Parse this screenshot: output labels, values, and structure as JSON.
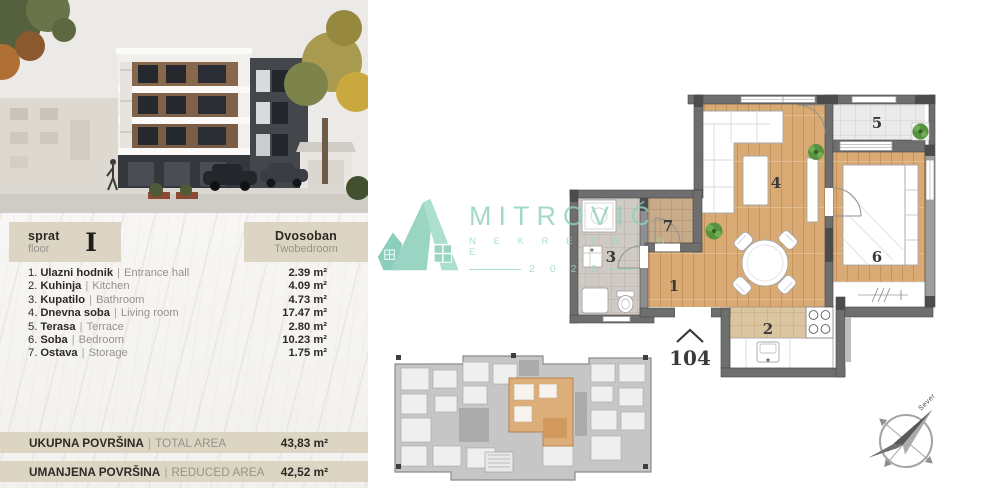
{
  "left_panel": {
    "sep": "|",
    "header": {
      "floor_label_sr": "sprat",
      "floor_label_en": "floor",
      "floor_value": "I",
      "unit_type_sr": "Dvosoban",
      "unit_type_en": "Twobedroom"
    },
    "rooms": [
      {
        "num": "1.",
        "sr": "Ulazni hodnik",
        "en": "Entrance hall",
        "area": "2.39 m²"
      },
      {
        "num": "2.",
        "sr": "Kuhinja",
        "en": "Kitchen",
        "area": "4.09 m²"
      },
      {
        "num": "3.",
        "sr": "Kupatilo",
        "en": "Bathroom",
        "area": "4.73 m²"
      },
      {
        "num": "4.",
        "sr": "Dnevna soba",
        "en": "Living room",
        "area": "17.47 m²"
      },
      {
        "num": "5.",
        "sr": "Terasa",
        "en": "Terrace",
        "area": "2.80 m²"
      },
      {
        "num": "6.",
        "sr": "Soba",
        "en": "Bedroom",
        "area": "10.23 m²"
      },
      {
        "num": "7.",
        "sr": "Ostava",
        "en": "Storage",
        "area": "1.75 m²"
      }
    ],
    "totals": [
      {
        "sr": "UKUPNA POVRŠINA",
        "en": "TOTAL AREA",
        "value": "43,83 m²"
      },
      {
        "sr": "UMANJENA POVRŠINA",
        "en": "REDUCED AREA",
        "value": "42,52 m²"
      }
    ]
  },
  "watermark": {
    "brand": "MITROVIĆ",
    "brand_sub": "N E K R E T N I N E",
    "year": "2 0 2 2",
    "color": "#8ed2bf"
  },
  "floorplan": {
    "unit_number": "104",
    "compass_label": "Sever",
    "labels": {
      "hall": "1",
      "kitchen": "2",
      "bathroom": "3",
      "living": "4",
      "terrace": "5",
      "bedroom": "6",
      "storage": "7"
    },
    "colors": {
      "wood": "#d9aa74",
      "wall": "#6e6e6e",
      "terrace_tile": "#ebebeb",
      "bath_tile": "#cfcac3",
      "kitchen_tile": "#dbc5a0",
      "storage_tile": "#c8ac8a",
      "keyplan_highlight": "#dcae79"
    }
  }
}
